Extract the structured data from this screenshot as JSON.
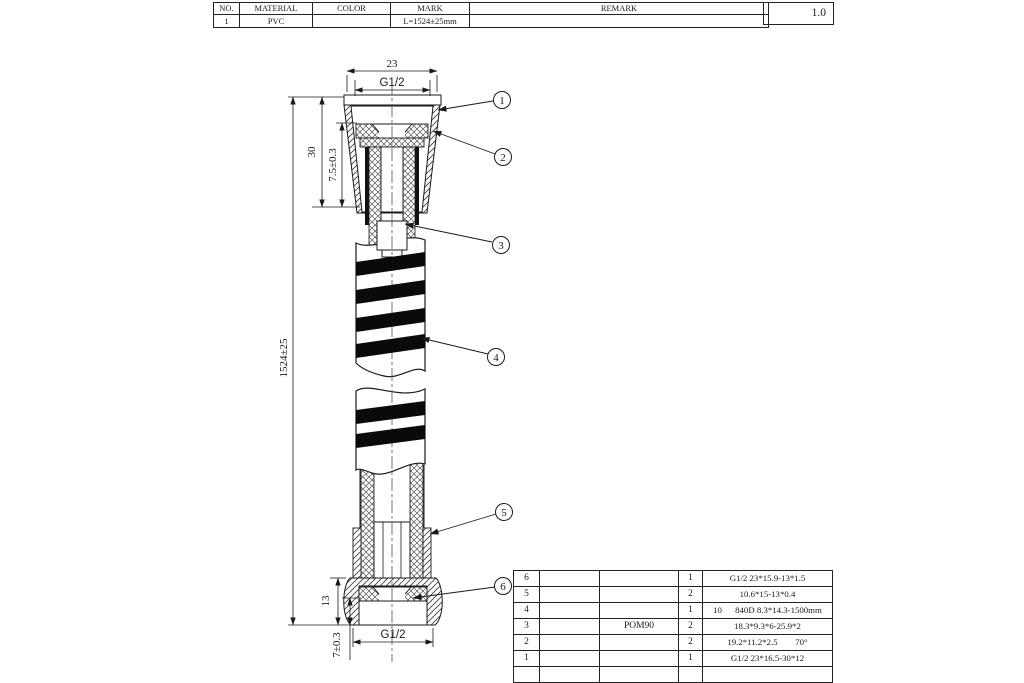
{
  "top_table": {
    "headers": [
      "NO.",
      "MATERIAL",
      "COLOR",
      "MARK",
      "REMARK"
    ],
    "row": {
      "no": "1",
      "material": "PVC",
      "color": "",
      "mark": "L=1524±25mm",
      "remark": ""
    },
    "version": "1.0"
  },
  "dimensions": {
    "width_top": "23",
    "thread_top": "G1/2",
    "height_30": "30",
    "depth_top": "7.5±0.3",
    "length": "1524±25",
    "height_13": "13",
    "depth_bottom": "7±0.3",
    "thread_bottom": "G1/2"
  },
  "callouts": [
    "1",
    "2",
    "3",
    "4",
    "5",
    "6"
  ],
  "parts_table": {
    "rows": [
      {
        "no": "6",
        "material": "",
        "qty": "1",
        "spec": "G1/2 23*15.9-13*1.5"
      },
      {
        "no": "5",
        "material": "",
        "qty": "2",
        "spec": "10.6*15-13*0.4"
      },
      {
        "no": "4",
        "material": "",
        "qty": "1",
        "spec": "10      840D 8.3*14.3-1500mm"
      },
      {
        "no": "3",
        "material": "POM90",
        "qty": "2",
        "spec": "18.3*9.3*6-25.9*2"
      },
      {
        "no": "2",
        "material": "",
        "qty": "2",
        "spec": "19.2*11.2*2.5        70°"
      },
      {
        "no": "1",
        "material": "",
        "qty": "1",
        "spec": "G1/2 23*16.5-30*12"
      }
    ]
  }
}
